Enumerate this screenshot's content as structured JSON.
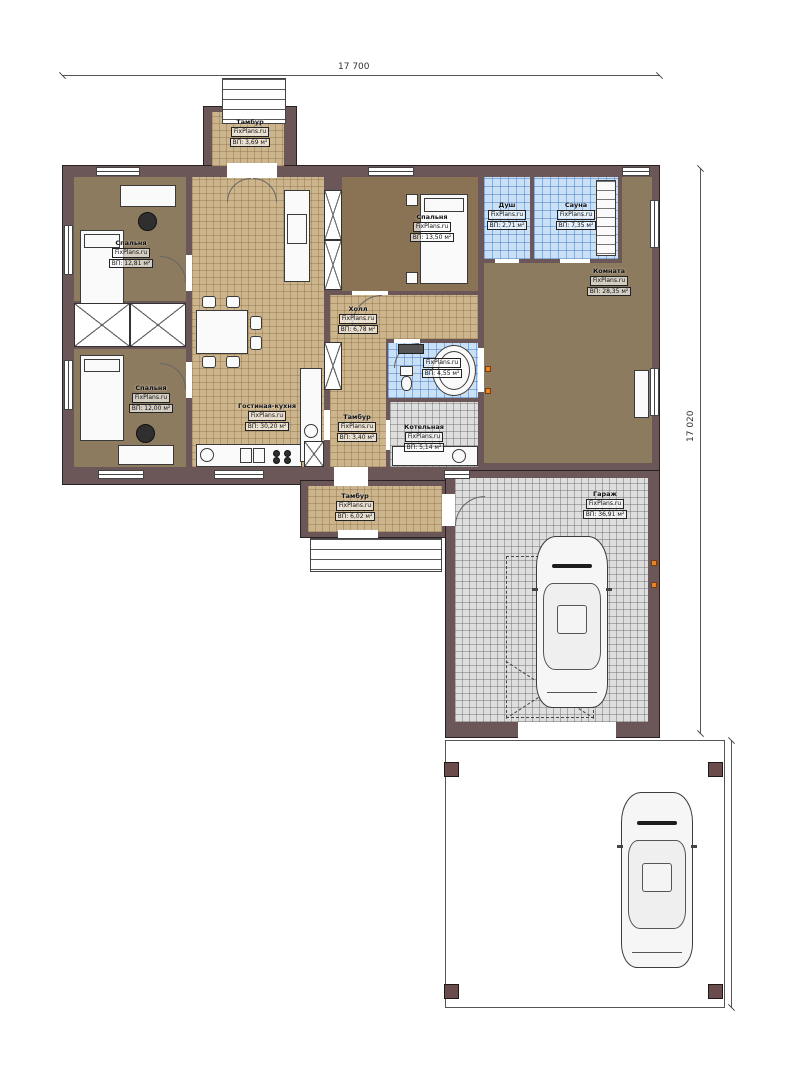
{
  "watermark": "FixPlans.ru",
  "dimensions": {
    "top": "17 700",
    "right": "17 020",
    "carport": "7 710"
  },
  "rooms": {
    "porch": {
      "name": "Тамбур",
      "area": "ВП: 3,69 м²"
    },
    "bedroom1": {
      "name": "Спальня",
      "area": "ВП: 12,81 м²"
    },
    "bedroom2": {
      "name": "Спальня",
      "area": "ВП: 12,00 м²"
    },
    "living": {
      "name": "Гостиная-кухня",
      "area": "ВП: 30,20 м²"
    },
    "bedroom3": {
      "name": "Спальня",
      "area": "ВП: 13,50 м²"
    },
    "shower": {
      "name": "Душ",
      "area": "ВП: 2,71 м²"
    },
    "sauna": {
      "name": "Сауна",
      "area": "ВП: 7,35 м²"
    },
    "room": {
      "name": "Комната",
      "area": "ВП: 28,35 м²"
    },
    "hall": {
      "name": "Холл",
      "area": "ВП: 6,78 м²"
    },
    "bathroom": {
      "name": "",
      "area": "ВП: 4,55 м²"
    },
    "tambour_mid": {
      "name": "Тамбур",
      "area": "ВП: 3,40 м²"
    },
    "boiler": {
      "name": "Котельная",
      "area": "ВП: 5,14 м²"
    },
    "tambour_side": {
      "name": "Тамбур",
      "area": "ВП: 6,02 м²"
    },
    "garage": {
      "name": "Гараж",
      "area": "ВП: 36,91 м²"
    }
  }
}
